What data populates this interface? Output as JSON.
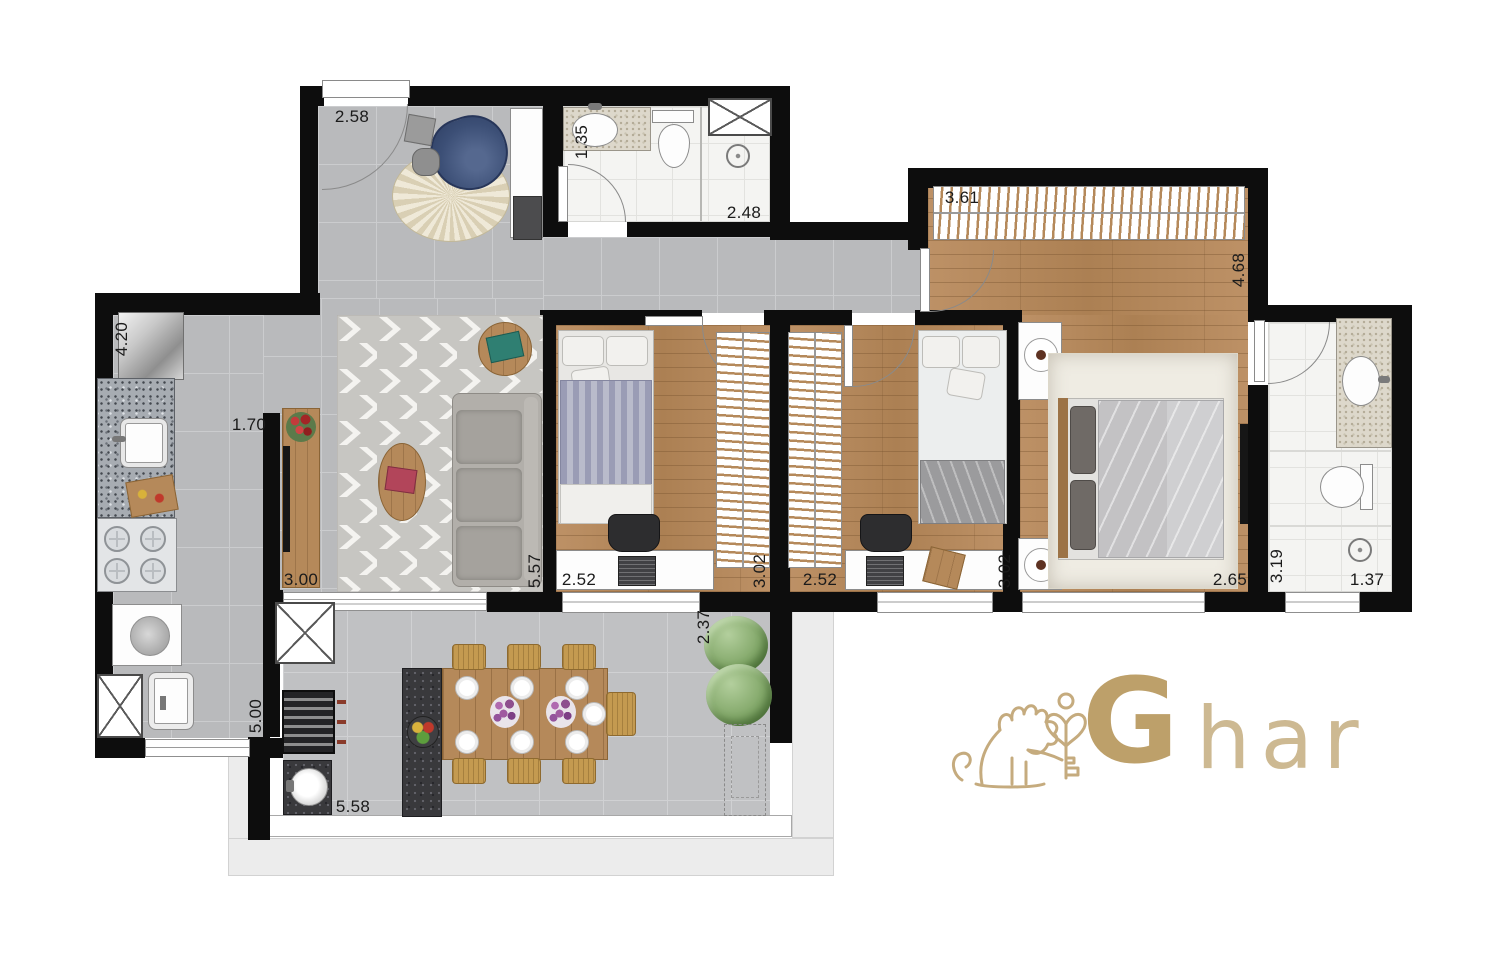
{
  "logo": {
    "g": "G",
    "rest": "har"
  },
  "dims": {
    "entry": "2.58",
    "bath1_w": "1.35",
    "bath1_l": "2.48",
    "master_w": "3.61",
    "master_l": "4.68",
    "master_b": "2.65",
    "kitchen_l": "4.20",
    "kitchen_w": "1.70",
    "kitchen_c": "5.00",
    "living_w": "3.00",
    "living_l": "5.57",
    "bed1_w": "2.52",
    "bed1_l": "3.02",
    "bed2_w": "2.52",
    "bed2_l": "3.02",
    "bath2_l": "3.19",
    "bath2_w": "1.37",
    "balcony_d": "2.37",
    "balcony_w": "5.58"
  }
}
